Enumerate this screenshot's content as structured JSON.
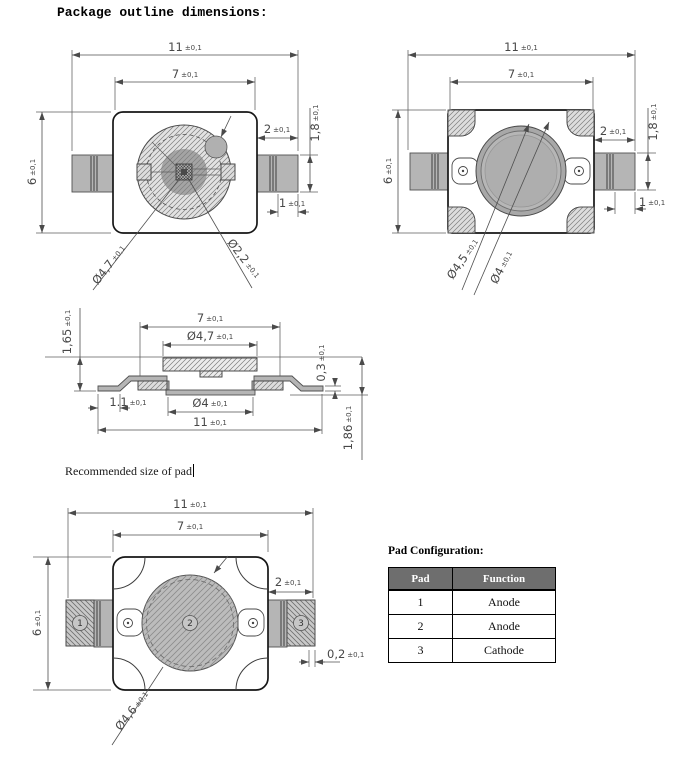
{
  "title": "Package outline dimensions:",
  "tolerance_label": "±0,1",
  "note_recommended_pad": "Recommended size of pad",
  "drawings": {
    "top_view": {
      "dims": {
        "overall_width": "11",
        "body_width": "7",
        "overall_height": "6",
        "lead_length": "2",
        "lead_width": "1,8",
        "lead_tip_length": "1",
        "lens_diameter": "Ø4,7",
        "die_circle_diameter": "Ø2,2"
      }
    },
    "top_view_2": {
      "dims": {
        "overall_width": "11",
        "body_width": "7",
        "overall_height": "6",
        "lead_length": "2",
        "lead_width": "1,8",
        "lead_tip_length": "1",
        "lens_outer_diameter": "Ø4,5",
        "lens_inner_diameter": "Ø4"
      }
    },
    "side_view": {
      "dims": {
        "body_width": "7",
        "lens_diameter": "Ø4,7",
        "standoff_height": "1,65",
        "plate_thickness": "0,3",
        "foot_length": "1.1",
        "slug_diameter": "Ø4",
        "overall_width": "11",
        "overall_height": "1,86"
      }
    },
    "pad_layout": {
      "dims": {
        "overall_width": "11",
        "body_width": "7",
        "overall_height": "6",
        "lead_length": "2",
        "pad_clearance": "0,2",
        "pad_diameter": "Ø4,6"
      },
      "pad_numbers": [
        "1",
        "2",
        "3"
      ]
    }
  },
  "pad_configuration": {
    "title": "Pad Configuration:",
    "headers": [
      "Pad",
      "Function"
    ],
    "rows": [
      [
        "1",
        "Anode"
      ],
      [
        "2",
        "Anode"
      ],
      [
        "3",
        "Cathode"
      ]
    ]
  }
}
